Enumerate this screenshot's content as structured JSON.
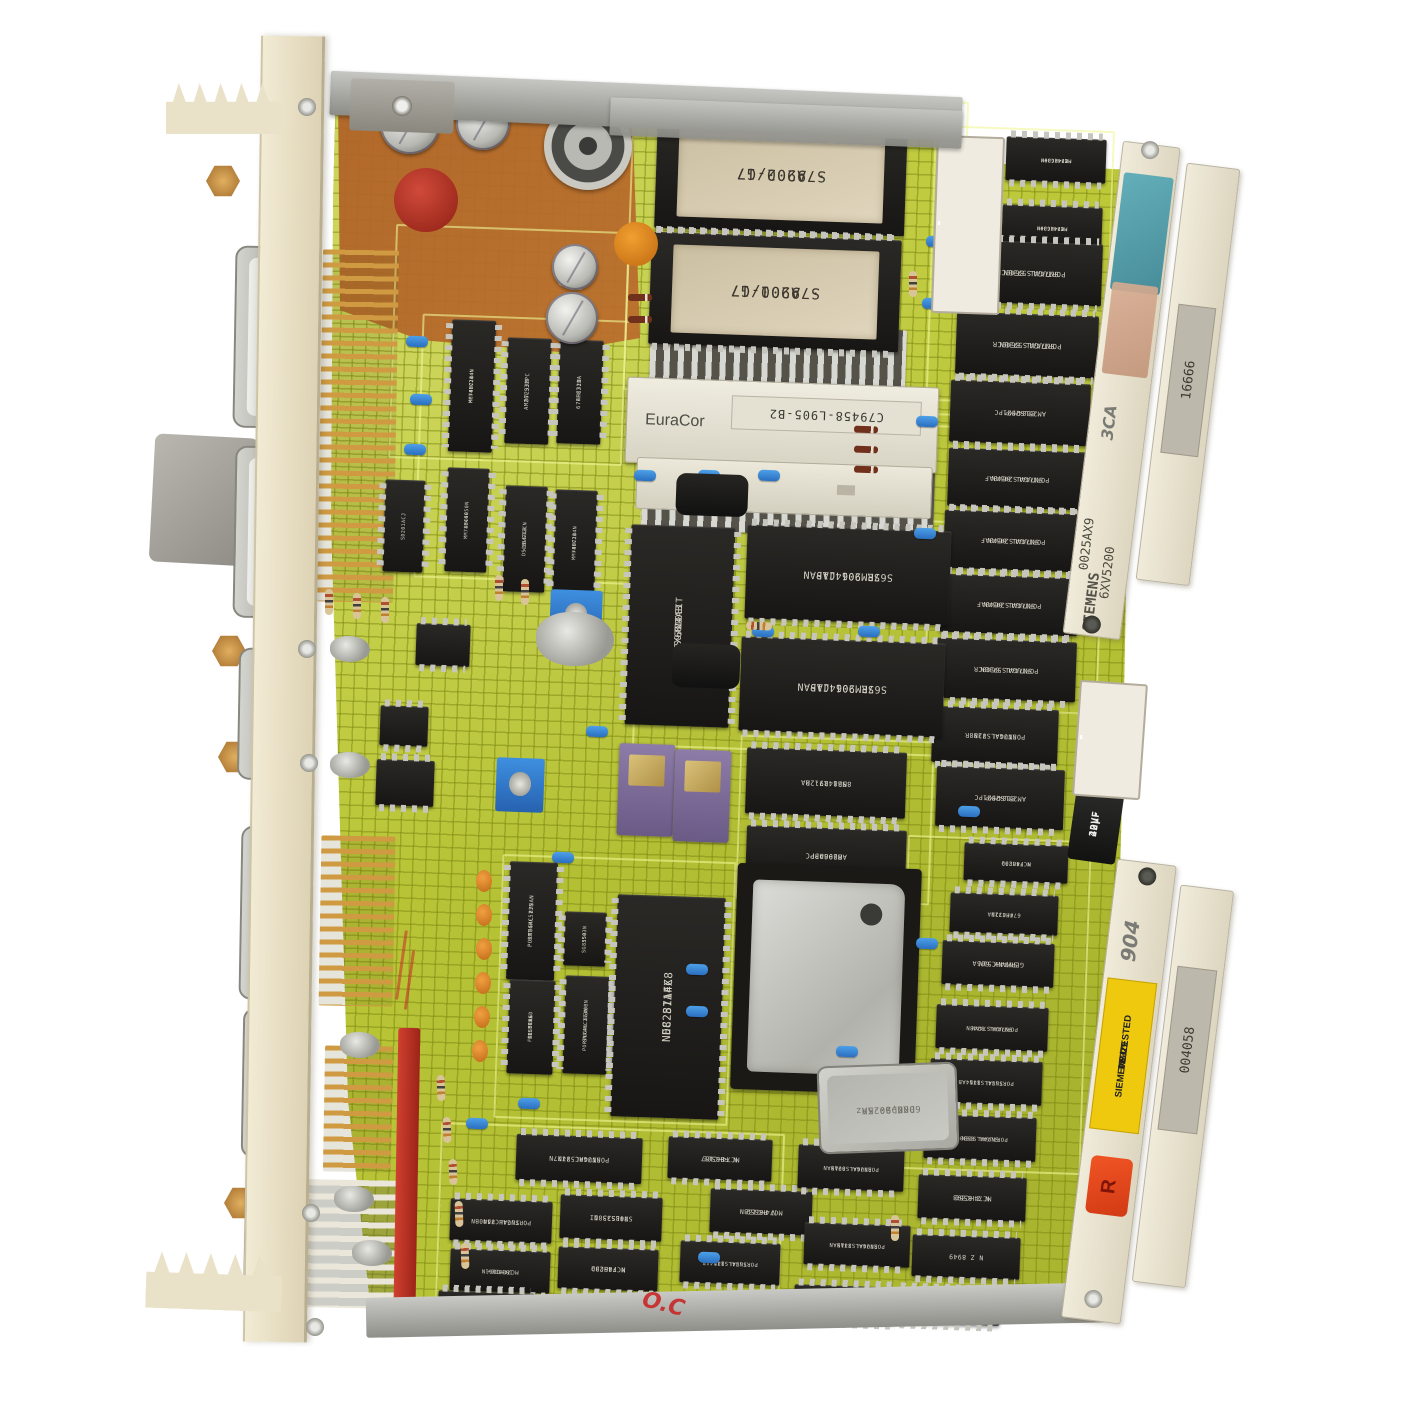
{
  "colors": {
    "pcb": "#bcc838",
    "trace": "#93a31c",
    "chip_body": "#1d1c1a",
    "panel": "#e9e1c8",
    "rail": "#eae5d3",
    "copper": "#b2661f",
    "dip_red": "#d9301e",
    "sticker_yellow": "#eec90e",
    "sticker_red": "#e8491f",
    "gold": "#cf9a42"
  },
  "eproms": [
    {
      "line1": "S79200-G7",
      "line2": "· A902/17"
    },
    {
      "line1": "S79200-G7",
      "line2": "· A901/17"
    }
  ],
  "euracor": {
    "brand": "EuraCor",
    "sticker": "C79458-L905-B2"
  },
  "rails": {
    "top": {
      "handwritten": "3CA",
      "code": "0025AX9",
      "product": "6XV5200",
      "brand": "SIEMENS",
      "sticker": "16666"
    },
    "bottom": {
      "handwritten": "904",
      "tested": {
        "line1": "SIEMENS/TESTED",
        "line2": "VP L1",
        "line3": "P5329"
      },
      "sticker": "004058",
      "red_tag": "R"
    }
  },
  "crystal": {
    "line1": "KDS-2",
    "line2": "6000,00 KHz",
    "line3": "DKC-20-5A"
  },
  "cap": {
    "line1": "22µF",
    "line2": "40V-"
  },
  "marks": {
    "red": "O.C"
  },
  "chips": [
    {
      "b": [
        1006,
        138,
        100,
        44
      ],
      "r": 2,
      "d": "h",
      "f": 1,
      "s": 5,
      "t": [
        "1B426B+",
        "MM74HC30N",
        "MC74HC30N"
      ]
    },
    {
      "b": [
        1002,
        206,
        100,
        44
      ],
      "r": 2,
      "d": "h",
      "f": 1,
      "s": 5,
      "t": [
        "1B426B+",
        "MM74HC30N",
        "MC74HC30N"
      ]
    },
    {
      "b": [
        960,
        242,
        142,
        62
      ],
      "r": 2,
      "d": "h",
      "f": 1,
      "s": 7,
      "t": [
        "PORTUGAL 8640CR",
        "SN74ALS573BN"
      ]
    },
    {
      "b": [
        956,
        314,
        142,
        62
      ],
      "r": 2,
      "d": "h",
      "f": 1,
      "s": 7,
      "t": [
        "PORTUGAL 8640CR",
        "SN74ALS573BN"
      ]
    },
    {
      "b": [
        950,
        382,
        140,
        62
      ],
      "r": 2,
      "d": "h",
      "f": 1,
      "s": 6.5,
      "t": [
        "AM25LS2521PC",
        "8604MMP"
      ]
    },
    {
      "b": [
        948,
        450,
        138,
        58
      ],
      "r": 2,
      "d": "h",
      "f": 1,
      "s": 6.5,
      "t": [
        "PORTUGAL 8640AF",
        "SN74ALS245AN"
      ]
    },
    {
      "b": [
        944,
        512,
        138,
        58
      ],
      "r": 2,
      "d": "h",
      "f": 1,
      "s": 6.5,
      "t": [
        "PORTUGAL 8640AF",
        "SN74ALS245AN"
      ]
    },
    {
      "b": [
        940,
        576,
        138,
        58
      ],
      "r": 2,
      "d": "h",
      "f": 1,
      "s": 6.5,
      "t": [
        "PORTUGAL 8640AF",
        "SN74ALS245AN"
      ]
    },
    {
      "b": [
        936,
        640,
        140,
        60
      ],
      "r": 2,
      "d": "h",
      "f": 1,
      "s": 6.5,
      "t": [
        "PORTUGAL 8640CR",
        "SN74ALS573BN"
      ]
    },
    {
      "b": [
        932,
        708,
        126,
        56
      ],
      "r": 2,
      "d": "h",
      "f": 1,
      "s": 6.5,
      "t": [
        "PORTUGAL 8288R",
        "SN74ALS73N"
      ]
    },
    {
      "b": [
        936,
        768,
        128,
        60
      ],
      "r": 2,
      "d": "h",
      "f": 1,
      "s": 6.5,
      "t": [
        "AM25LS2521PC",
        "8604MMP"
      ]
    },
    {
      "b": [
        746,
        750,
        160,
        66
      ],
      "r": 2,
      "d": "h",
      "f": 1,
      "s": 7,
      "t": [
        "MB8417-20",
        "8521 R91 RA"
      ]
    },
    {
      "b": [
        746,
        828,
        160,
        56
      ],
      "r": 2,
      "d": "h",
      "f": 1,
      "s": 7,
      "t": [
        "AM29843PC",
        "8606DPP"
      ]
    },
    {
      "b": [
        746,
        528,
        204,
        94
      ],
      "r": 2,
      "d": "h",
      "f": 1,
      "s": 10,
      "t": [
        "SRM2064C15",
        "S67E 901  JAPAN"
      ]
    },
    {
      "b": [
        740,
        640,
        204,
        94
      ],
      "r": 2,
      "d": "h",
      "f": 1,
      "s": 10,
      "t": [
        "SRM2064C15",
        "S67E 901  JAPAN"
      ]
    },
    {
      "b": [
        628,
        526,
        104,
        200
      ],
      "r": 2,
      "d": "v",
      "f": 1,
      "s": 9,
      "t": [
        "S9724AB",
        "SCX6810EIT",
        "/N1"
      ]
    },
    {
      "b": [
        450,
        320,
        44,
        132
      ],
      "r": 2,
      "d": "v",
      "f": 1,
      "s": 5,
      "t": [
        "+8071B",
        "MM74HC244N",
        "MC74HC244N"
      ]
    },
    {
      "b": [
        506,
        338,
        44,
        106
      ],
      "r": 2,
      "d": "v",
      "f": 1,
      "s": 5.5,
      "t": [
        "8723JM",
        "AM26LS32PC"
      ]
    },
    {
      "b": [
        558,
        340,
        44,
        104
      ],
      "r": 2,
      "d": "v",
      "f": 1,
      "s": 5.5,
      "t": [
        "74HC32N",
        "6 FF8712A"
      ]
    },
    {
      "b": [
        446,
        468,
        42,
        104
      ],
      "r": 2,
      "d": "v",
      "f": 1,
      "s": 5,
      "t": [
        "1B466",
        "MM74HC4050N"
      ]
    },
    {
      "b": [
        504,
        486,
        42,
        106
      ],
      "r": 2,
      "d": "v",
      "f": 1,
      "s": 5,
      "t": [
        "<1B471B",
        "DS26LS32CN"
      ]
    },
    {
      "b": [
        554,
        490,
        42,
        106
      ],
      "r": 2,
      "d": "v",
      "f": 1,
      "s": 5,
      "t": [
        "+8071B",
        "MM74HC244N"
      ]
    },
    {
      "b": [
        384,
        480,
        40,
        92
      ],
      "r": 2,
      "d": "v",
      "f": 1,
      "s": 5,
      "t": [
        "SD201ACJ"
      ]
    },
    {
      "b": [
        416,
        624,
        54,
        42
      ],
      "r": 2,
      "d": "h",
      "f": 0,
      "t": []
    },
    {
      "b": [
        380,
        706,
        48,
        40
      ],
      "r": 2,
      "d": "h",
      "f": 0,
      "t": []
    },
    {
      "b": [
        376,
        760,
        58,
        46
      ],
      "r": 2,
      "d": "h",
      "f": 0,
      "t": []
    },
    {
      "b": [
        508,
        862,
        48,
        118
      ],
      "r": 2,
      "d": "v",
      "f": 1,
      "s": 5.5,
      "t": [
        "PORTUGAL 873AN",
        "SN74HC573N"
      ]
    },
    {
      "b": [
        564,
        912,
        42,
        54
      ],
      "r": 2,
      "d": "v",
      "f": 1,
      "s": 5,
      "t": [
        "SG 3503N",
        "8550"
      ]
    },
    {
      "b": [
        564,
        976,
        44,
        98
      ],
      "r": 2,
      "d": "v",
      "f": 1,
      "s": 5,
      "t": [
        "PORTUGAL 8640BN",
        "SN74HC273N"
      ]
    },
    {
      "b": [
        508,
        980,
        46,
        94
      ],
      "r": 2,
      "d": "v",
      "f": 1,
      "s": 5,
      "t": [
        "SIEMENS",
        "FZL 514GD",
        "AUSTRIA"
      ]
    },
    {
      "b": [
        614,
        896,
        108,
        222
      ],
      "r": 2,
      "d": "v",
      "f": 1,
      "s": 11,
      "t": [
        "NEC  8714X8",
        "D8251AFC"
      ]
    },
    {
      "b": [
        516,
        1136,
        126,
        46
      ],
      "r": 2,
      "d": "h",
      "f": 1,
      "s": 6.5,
      "t": [
        "PORTUGAL 8777N",
        "SN74HC574N"
      ]
    },
    {
      "b": [
        668,
        1138,
        104,
        42
      ],
      "r": 2,
      "d": "h",
      "f": 1,
      "s": 6.5,
      "t": [
        "MC74HC157",
        "N F8650E"
      ]
    },
    {
      "b": [
        450,
        1200,
        102,
        42
      ],
      "r": 2,
      "d": "h",
      "f": 1,
      "s": 6,
      "t": [
        "PORTUGAL 8540BN",
        "SN74HC74N"
      ]
    },
    {
      "b": [
        560,
        1196,
        102,
        44
      ],
      "r": 2,
      "d": "h",
      "f": 1,
      "s": 6.5,
      "t": [
        "74LS258N",
        "SN08533 II"
      ]
    },
    {
      "b": [
        710,
        1190,
        102,
        44
      ],
      "r": 2,
      "d": "h",
      "f": 1,
      "s": 6.5,
      "t": [
        "N P8652",
        "MC74HC138N"
      ]
    },
    {
      "b": [
        450,
        1250,
        100,
        42
      ],
      "r": 2,
      "d": "h",
      "f": 1,
      "s": 5.5,
      "t": [
        "1B38B6+",
        "MC74HC161N"
      ]
    },
    {
      "b": [
        558,
        1248,
        100,
        42
      ],
      "r": 2,
      "d": "h",
      "f": 1,
      "s": 6.5,
      "t": [
        "MC74HC02",
        "N F8623D"
      ]
    },
    {
      "b": [
        680,
        1242,
        100,
        42
      ],
      "r": 2,
      "d": "h",
      "f": 1,
      "s": 5.5,
      "t": [
        "PORTUGAL 8714AB",
        "SN74LS14N"
      ]
    },
    {
      "b": [
        798,
        1146,
        106,
        44
      ],
      "r": 2,
      "d": "h",
      "f": 1,
      "s": 5.5,
      "t": [
        "PORTUGAL 8713AN",
        "SN74ALS00AN"
      ]
    },
    {
      "b": [
        804,
        1224,
        106,
        42
      ],
      "r": 2,
      "d": "h",
      "f": 1,
      "s": 5.5,
      "t": [
        "PORTUGAL 8715AN",
        "SN74ALS74AN"
      ]
    },
    {
      "b": [
        794,
        1286,
        102,
        36
      ],
      "r": 2,
      "d": "h",
      "f": 1,
      "s": 5.5,
      "t": [
        "SN74ALS74AN"
      ]
    },
    {
      "b": [
        964,
        844,
        104,
        38
      ],
      "r": 2,
      "d": "h",
      "f": 1,
      "s": 5.5,
      "t": [
        "MC74HC02",
        "N F8623D"
      ]
    },
    {
      "b": [
        950,
        894,
        108,
        40
      ],
      "r": 2,
      "d": "h",
      "f": 1,
      "s": 5.5,
      "t": [
        "74HC32N",
        "6 FF8712A"
      ]
    },
    {
      "b": [
        942,
        942,
        112,
        44
      ],
      "r": 2,
      "d": "h",
      "f": 1,
      "s": 6.5,
      "t": [
        "GERMANY 605A",
        "SN74HC51N"
      ]
    },
    {
      "b": [
        936,
        1006,
        112,
        44
      ],
      "r": 2,
      "d": "h",
      "f": 1,
      "s": 5.5,
      "t": [
        "PORTUGAL 8748N",
        "SN74ALS74AN"
      ]
    },
    {
      "b": [
        930,
        1060,
        112,
        44
      ],
      "r": 2,
      "d": "h",
      "f": 1,
      "s": 5.5,
      "t": [
        "PORTUGAL 8714AB",
        "SN74LS14N"
      ]
    },
    {
      "b": [
        924,
        1116,
        112,
        44
      ],
      "r": 2,
      "d": "h",
      "f": 1,
      "s": 5.5,
      "t": [
        "PORTUGAL 8530CP",
        "SN74ALS08N"
      ]
    },
    {
      "b": [
        918,
        1176,
        108,
        44
      ],
      "r": 2,
      "d": "h",
      "f": 1,
      "s": 6.5,
      "t": [
        "MC74HC393",
        "N Z 8550"
      ]
    },
    {
      "b": [
        912,
        1236,
        108,
        42
      ],
      "r": 2,
      "d": "h",
      "f": 1,
      "s": 6.5,
      "t": [
        "N Z 8949"
      ]
    },
    {
      "b": [
        896,
        1290,
        104,
        34
      ],
      "r": 2,
      "d": "h",
      "f": 1,
      "s": 5.5,
      "t": [
        "SN74ALS08N"
      ]
    },
    {
      "b": [
        438,
        1292,
        96,
        34
      ],
      "r": 2,
      "d": "h",
      "f": 0,
      "t": []
    }
  ],
  "dips": [
    {
      "b": [
        934,
        136,
        68,
        178
      ],
      "n": 6,
      "r": 2
    },
    {
      "b": [
        1076,
        682,
        68,
        116
      ],
      "n": 7,
      "r": 4
    }
  ],
  "silk": [
    [
      392,
      228,
      234,
      234
    ],
    [
      636,
      516,
      336,
      236
    ],
    [
      928,
      428,
      174,
      284
    ],
    [
      438,
      1128,
      344,
      184
    ],
    [
      902,
      838,
      184,
      334
    ],
    [
      418,
      318,
      262,
      264
    ],
    [
      498,
      858,
      234,
      264
    ],
    [
      738,
      738,
      194,
      164
    ],
    [
      628,
      96,
      336,
      300
    ],
    [
      930,
      128,
      180,
      290
    ]
  ],
  "combs": [
    [
      320,
      250,
      76,
      352,
      "g"
    ],
    [
      320,
      836,
      74,
      170,
      "g"
    ],
    [
      324,
      1046,
      68,
      126,
      "g"
    ],
    [
      298,
      1180,
      112,
      128,
      "w"
    ]
  ],
  "strips": [
    [
      650,
      326,
      256,
      60
    ],
    [
      642,
      468,
      292,
      66
    ]
  ],
  "dsubs": [
    [
      234,
      246,
      182
    ],
    [
      234,
      446,
      172
    ],
    [
      238,
      648,
      132
    ],
    [
      240,
      826,
      174
    ],
    [
      242,
      1008,
      150
    ],
    [
      244,
      1184,
      122
    ]
  ],
  "decor": {
    "jumpers": [
      [
        406,
        336
      ],
      [
        410,
        394
      ],
      [
        404,
        444
      ],
      [
        634,
        470
      ],
      [
        698,
        470
      ],
      [
        758,
        470
      ],
      [
        916,
        416
      ],
      [
        922,
        298
      ],
      [
        926,
        236
      ],
      [
        752,
        626
      ],
      [
        858,
        626
      ],
      [
        914,
        528
      ],
      [
        552,
        852
      ],
      [
        518,
        1098
      ],
      [
        686,
        964
      ],
      [
        686,
        1006
      ],
      [
        916,
        938
      ],
      [
        958,
        806
      ],
      [
        698,
        1252
      ],
      [
        466,
        1118
      ],
      [
        586,
        726
      ],
      [
        836,
        1046
      ]
    ],
    "resistors": [
      [
        316,
        598,
        90
      ],
      [
        344,
        602,
        90
      ],
      [
        372,
        606,
        90
      ],
      [
        486,
        584,
        90
      ],
      [
        512,
        588,
        90
      ],
      [
        558,
        280,
        12
      ],
      [
        564,
        302,
        12
      ],
      [
        428,
        1084,
        88
      ],
      [
        434,
        1126,
        88
      ],
      [
        440,
        1168,
        88
      ],
      [
        446,
        1210,
        88
      ],
      [
        452,
        1252,
        88
      ],
      [
        882,
        1224,
        90
      ],
      [
        746,
        622,
        3
      ],
      [
        900,
        280,
        90
      ]
    ],
    "diodes": [
      [
        854,
        426,
        2
      ],
      [
        854,
        446,
        2
      ],
      [
        854,
        466,
        2
      ],
      [
        628,
        294,
        0
      ],
      [
        628,
        316,
        0
      ]
    ],
    "orange_caps": [
      [
        476,
        870
      ],
      [
        476,
        904
      ],
      [
        476,
        938
      ],
      [
        475,
        972
      ],
      [
        474,
        1006
      ],
      [
        472,
        1040
      ]
    ],
    "electrolytics": [
      [
        380,
        94,
        60
      ],
      [
        456,
        96,
        54
      ],
      [
        552,
        244,
        46
      ],
      [
        546,
        292,
        52
      ]
    ],
    "toroid": [
      544,
      102,
      88
    ],
    "red_disc": [
      394,
      168,
      64
    ],
    "orange_disc": [
      614,
      222,
      44
    ],
    "purple_ics": [
      [
        618,
        744,
        56,
        92
      ],
      [
        674,
        750,
        56,
        92
      ]
    ],
    "trimmers": [
      [
        496,
        758,
        48,
        54
      ],
      [
        550,
        590,
        52,
        50
      ]
    ],
    "grey_blob": [
      536,
      612,
      78,
      54
    ],
    "transistors": [
      [
        676,
        474,
        72,
        42
      ],
      [
        672,
        644,
        68,
        44
      ]
    ],
    "red_strip": [
      396,
      1028,
      22,
      272
    ],
    "solder": [
      [
        330,
        636
      ],
      [
        330,
        752
      ],
      [
        334,
        1186
      ],
      [
        340,
        1032
      ],
      [
        352,
        1240
      ]
    ],
    "screws": [
      [
        298,
        98
      ],
      [
        298,
        640
      ],
      [
        300,
        754
      ],
      [
        302,
        1204
      ],
      [
        306,
        1318
      ]
    ],
    "hex": [
      [
        206,
        164
      ],
      [
        212,
        634
      ],
      [
        218,
        740
      ],
      [
        224,
        1186
      ]
    ],
    "redlines": [
      [
        400,
        930,
        3,
        70
      ],
      [
        408,
        950,
        3,
        60
      ]
    ]
  }
}
